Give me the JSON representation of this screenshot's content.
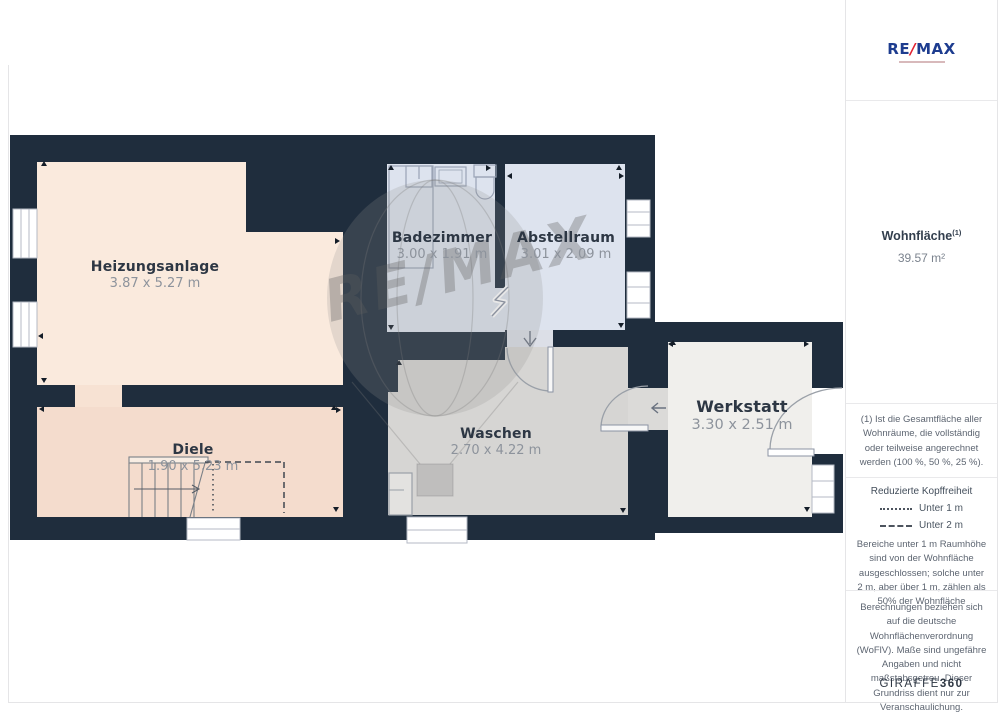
{
  "watermark": {
    "text": "RE/MAX"
  },
  "rooms": [
    {
      "name": "Heizungsanlage",
      "dims": "3.87 x 5.27 m"
    },
    {
      "name": "Badezimmer",
      "dims": "3.00 x 1.91 m"
    },
    {
      "name": "Abstellraum",
      "dims": "3.01 x 2.09 m"
    },
    {
      "name": "Diele",
      "dims": "1.90 x 5.23 m"
    },
    {
      "name": "Waschen",
      "dims": "2.70 x 4.22 m"
    },
    {
      "name": "Werkstatt",
      "dims": "3.30 x 2.51 m"
    }
  ],
  "sidebar": {
    "logo": {
      "re": "RE",
      "slash": "/",
      "max": "MAX"
    },
    "area_label": "Wohnfläche",
    "area_sup": "(1)",
    "area_value": "39.57 m²",
    "footnote": "(1) Ist die Gesamtfläche aller Wohnräume, die vollständig oder teilweise angerechnet werden (100 %, 50 %, 25 %).",
    "headroom": {
      "title": "Reduzierte Kopffreiheit",
      "legend": [
        {
          "style": "dotted",
          "label": "Unter 1 m"
        },
        {
          "style": "dashed",
          "label": "Unter 2 m"
        }
      ],
      "note": "Bereiche unter 1 m Raumhöhe sind von der Wohnfläche ausgeschlossen; solche unter 2 m, aber über 1 m, zählen als 50% der Wohnfläche"
    },
    "disclaimer": "Berechnungen beziehen sich auf die deutsche Wohnflächenverordnung (WoFlV). Maße sind ungefähre Angaben und nicht maßstabsgetreu. Dieser Grundriss dient nur zur Veranschaulichung.",
    "brand": {
      "giraffe": "GIRAFFE",
      "threesixty": "360"
    }
  },
  "colors": {
    "wall": "#1f2d3d",
    "heizungsanlage": "#faeadd",
    "diele": "#f4dccd",
    "bad_abstell": "#dde3ee",
    "waschen": "#d6d5d3",
    "werkstatt": "#f0efec",
    "remax_blue": "#1d3c8f",
    "remax_red": "#e01f2f"
  }
}
